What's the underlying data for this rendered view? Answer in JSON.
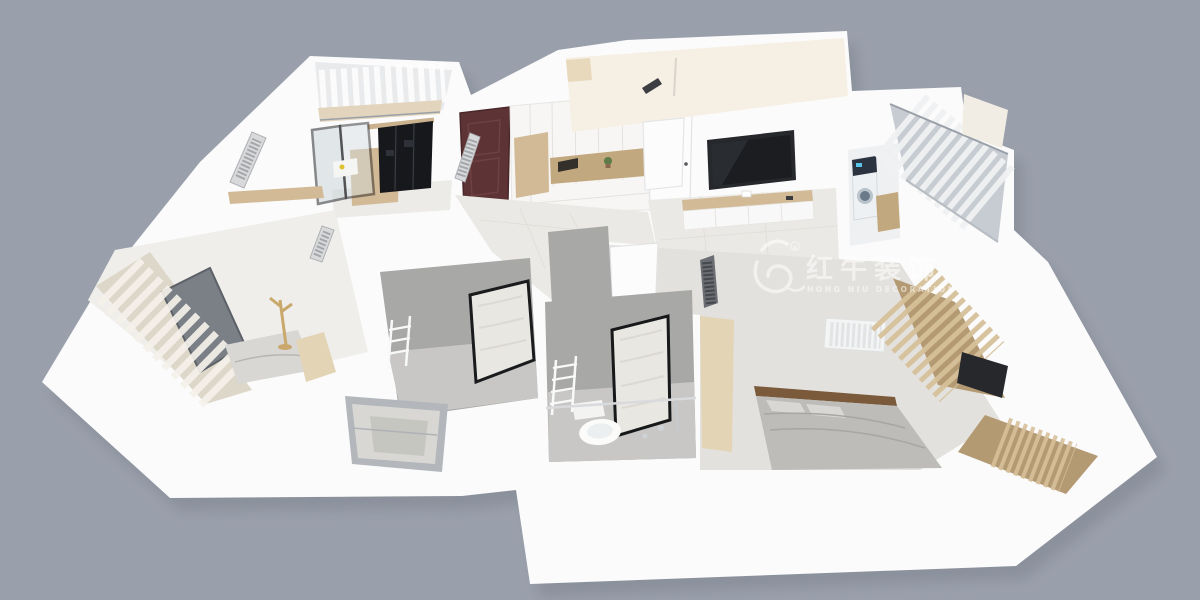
{
  "image": {
    "kind": "3d-floorplan-cutaway-render",
    "view": "top-down wide-angle dollhouse view of a three-bedroom apartment, white walls on plain gray backdrop"
  },
  "watermark": {
    "logo": "bull-icon",
    "registered_mark": "R",
    "brand_cn": "红牛装饰",
    "brand_en": "HONG NIU DECORATION",
    "opacity": 0.55
  },
  "palette": {
    "background": "#9aa0ab",
    "shadow": "#767b86",
    "wall": "#fbfbfc",
    "wall-shade": "#e9eaec",
    "floor-tile": "#ebe9e5",
    "floor-warm": "#f6efe3",
    "wood": "#d2ba96",
    "wood-dark": "#c2a87e",
    "wood-light": "#e4d4b6",
    "black-gloss": "#17181c",
    "door-walnut": "#5d3335",
    "bath-wall": "#a8a8a6",
    "bath-floor": "#c8c7c5",
    "frosted-glass": "#e9e7e2",
    "glass-frame": "#141518",
    "glass-tint": "#c8d2d7",
    "bed-gray": "#bdbcb8",
    "bed-light": "#d8d7d4",
    "curtain-cream": "#ddd7c9",
    "curtain-cream-hi": "#f4f1ea",
    "curtain-sheer-base": "#c7ccd2",
    "curtain-sheer-hi": "#eff0f1",
    "curtain-tan-base": "#b49a72",
    "curtain-tan-hi": "#d6c09a",
    "tv-dark": "#26282c",
    "radiator-hatch": "#d8d9db",
    "radiator-line": "#8f9194",
    "metal": "#d8dadc",
    "washer-accent": "#58c6e8",
    "plant-green": "#5d7c4a",
    "watermark-white": "#ffffff"
  },
  "scene": {
    "rooms": [
      {
        "id": "balcony-northwest",
        "features": [
          "white paneled walls",
          "beige floor strip"
        ]
      },
      {
        "id": "kitchen",
        "features": [
          "black framed glass sliding doors",
          "black gloss cabinets",
          "wood floor",
          "counter with yellow dish"
        ]
      },
      {
        "id": "entry",
        "features": [
          "dark walnut front door",
          "white storage cabinets",
          "wood seat niche",
          "open shelf with plant and books",
          "leaning radiator panel",
          "white interior door"
        ]
      },
      {
        "id": "dining-room",
        "features": [
          "cream walls",
          "small dark radiator",
          "wall pipe"
        ]
      },
      {
        "id": "living-room",
        "features": [
          "wall-mounted tv",
          "wood-top tv console",
          "white door",
          "tile floor"
        ]
      },
      {
        "id": "laundry",
        "features": [
          "washing machine",
          "wood cabinet"
        ]
      },
      {
        "id": "balcony-northeast",
        "features": [
          "sheer gray-white curtains",
          "glass frame"
        ]
      },
      {
        "id": "bedroom-master",
        "features": [
          "gray bed with wood headboard",
          "pillows",
          "white wall radiator",
          "tan curtains",
          "wardrobe tv",
          "corner wood blinds bay",
          "dark radiator panel",
          "white door"
        ]
      },
      {
        "id": "bathroom-main",
        "features": [
          "gray tile",
          "toilet",
          "towel ladder radiator",
          "frosted glass door",
          "shower rail"
        ]
      },
      {
        "id": "bathroom-second",
        "features": [
          "gray tile",
          "towel ladder radiator",
          "frosted glass door"
        ]
      },
      {
        "id": "bedroom-second",
        "features": [
          "cream pleated curtains",
          "window behind curtains",
          "bed",
          "wood coat rack",
          "wood wardrobe strip",
          "wood ledge",
          "two hatched radiator panels"
        ]
      },
      {
        "id": "hallway",
        "features": [
          "light marble tile"
        ]
      },
      {
        "id": "exterior-window",
        "features": [
          "gray framed double sash window in outer wall"
        ]
      }
    ]
  }
}
